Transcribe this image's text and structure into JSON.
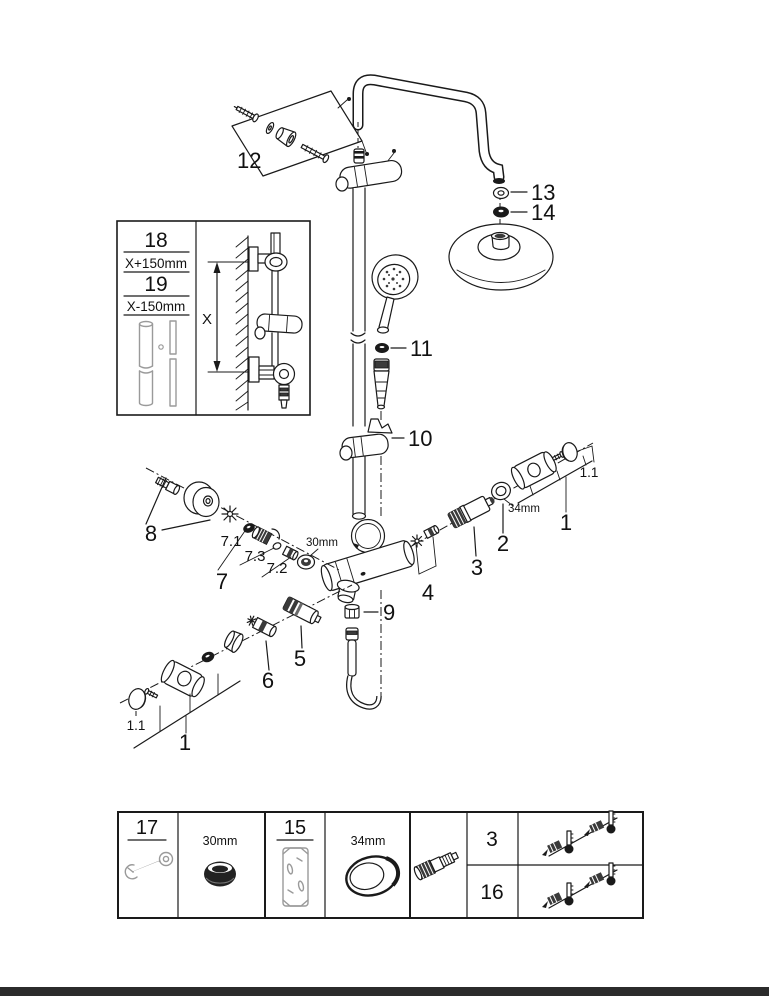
{
  "page": {
    "background": "#ffffff",
    "ink": "#1a1a1a",
    "footer_bar_color": "#2b2b2b"
  },
  "callouts": {
    "part12": "12",
    "part13": "13",
    "part14": "14",
    "part11": "11",
    "part10": "10",
    "part9": "9",
    "part8": "8",
    "part7": "7",
    "part7_1": "7.1",
    "part7_3": "7.3",
    "part7_2": "7.2",
    "size30mm": "30mm",
    "part6": "6",
    "part5": "5",
    "part4": "4",
    "part3": "3",
    "part2": "2",
    "size34mm": "34mm",
    "part1_right": "1",
    "part1_1_right": "1.1",
    "part1_left": "1",
    "part1_1_left": "1.1"
  },
  "inset": {
    "part18": "18",
    "offset18": "X+150mm",
    "part19": "19",
    "offset19": "X-150mm",
    "dimension_label": "X"
  },
  "tools_table": {
    "tool17": "17",
    "wrench_size_30": "30mm",
    "tool15": "15",
    "wrench_size_34": "34mm",
    "row_part3": "3",
    "row_part16": "16"
  }
}
